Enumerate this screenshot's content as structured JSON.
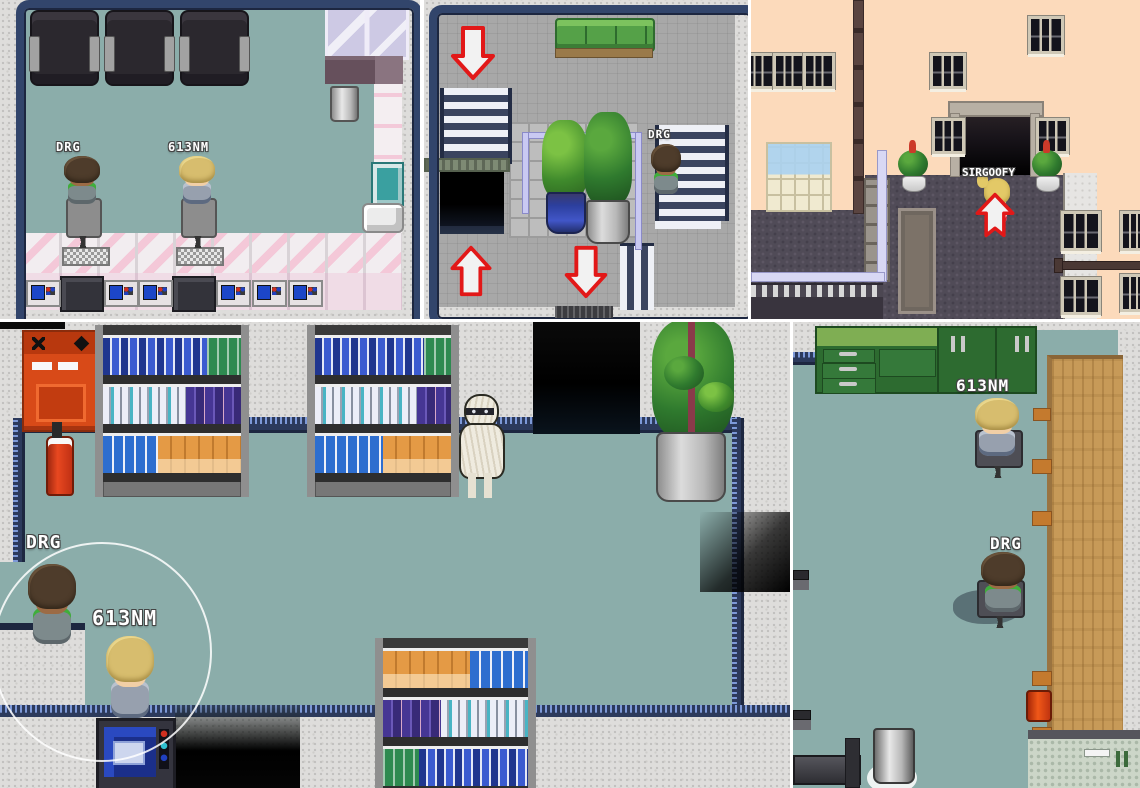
{
  "panels": {
    "cafe": {
      "players": [
        {
          "name": "DRG"
        },
        {
          "name": "613NM"
        }
      ]
    },
    "stairwell": {
      "players": [
        {
          "name": "DRG"
        }
      ],
      "arrows": [
        "down",
        "up",
        "down"
      ]
    },
    "street": {
      "players": [
        {
          "name": "SIRGOOFY"
        }
      ],
      "arrows": [
        "up"
      ]
    },
    "store": {
      "players": [
        {
          "name": "DRG"
        },
        {
          "name": "613NM"
        }
      ]
    },
    "breakroom": {
      "players": [
        {
          "name": "613NM"
        },
        {
          "name": "DRG"
        }
      ]
    }
  },
  "icons": {
    "warp_down": "red-outline-down-arrow",
    "warp_up": "red-outline-up-arrow"
  },
  "colors": {
    "floor_teal": "#8badaa",
    "tile_gray": "#a8a8a8",
    "wall_speckle": "#dedddb",
    "border_navy": "#2c3a5c",
    "arrow_red": "#e21818",
    "peach_wall": "#fcdabb",
    "roof_slate": "#504b57",
    "cabinet_green": "#2d6b30",
    "machine_orange": "#d84a18",
    "couch_green": "#55a148",
    "wood_counter": "#c79a58"
  }
}
